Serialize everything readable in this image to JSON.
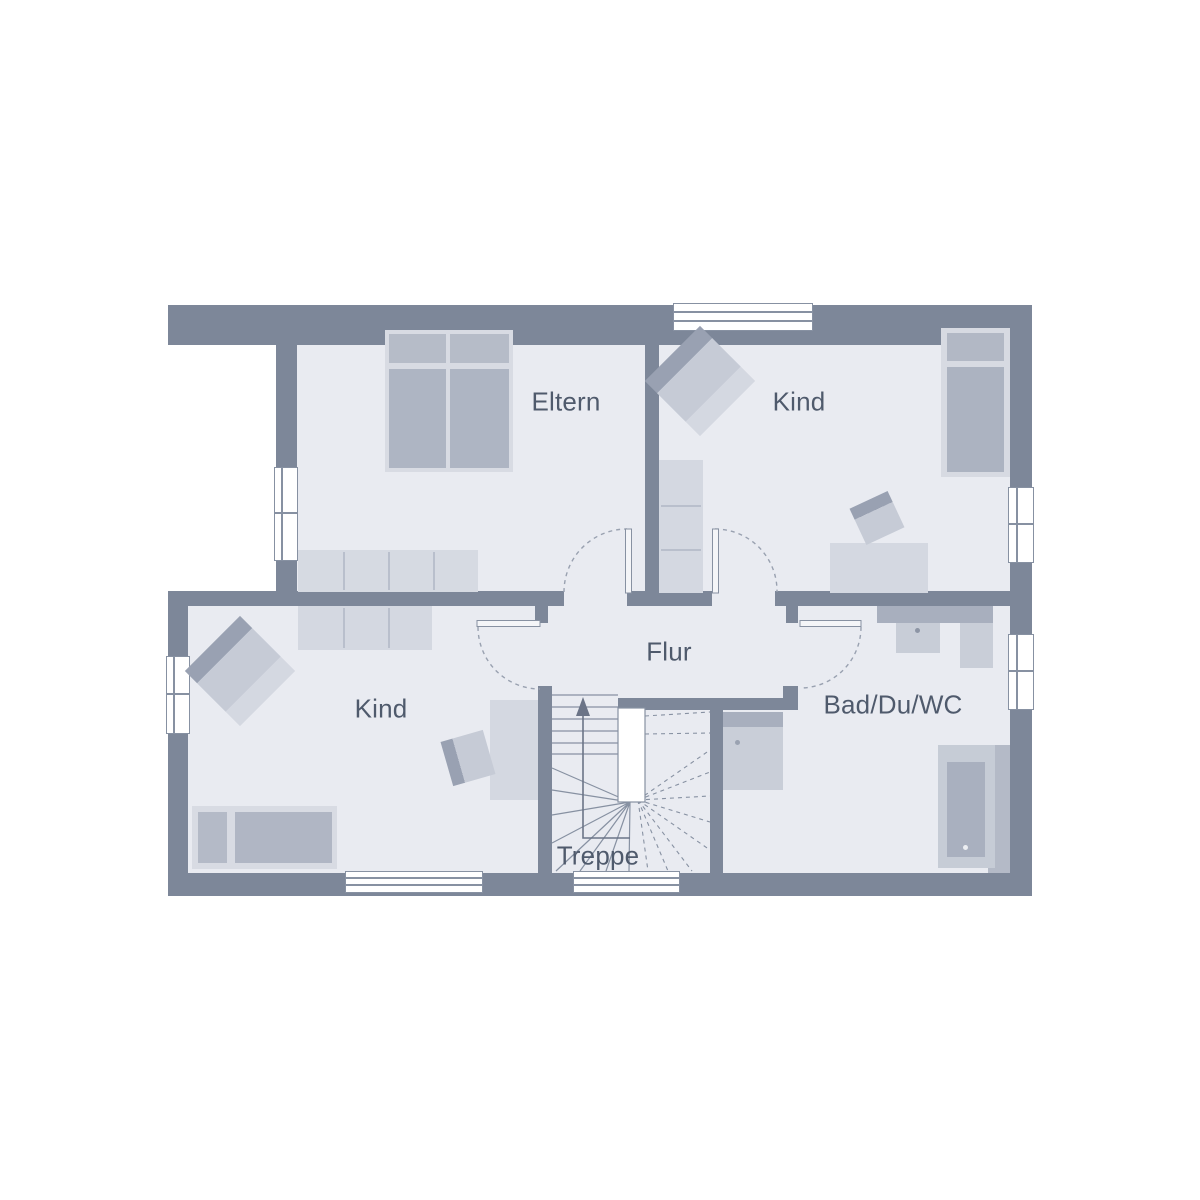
{
  "rooms": {
    "eltern": {
      "label": "Eltern"
    },
    "kind_top": {
      "label": "Kind"
    },
    "kind_bottom": {
      "label": "Kind"
    },
    "flur": {
      "label": "Flur"
    },
    "bad": {
      "label": "Bad/Du/WC"
    },
    "treppe": {
      "label": "Treppe",
      "direction_arrow": "up"
    }
  },
  "colors": {
    "wall": "#7d8799",
    "floor": "#e9ebf1",
    "furniture_light": "#d6dae2",
    "furniture_mid": "#b3b9c6",
    "furniture_dark": "#99a1b2",
    "line": "#8791a2",
    "text": "#4f5a6c",
    "background": "#ffffff"
  }
}
